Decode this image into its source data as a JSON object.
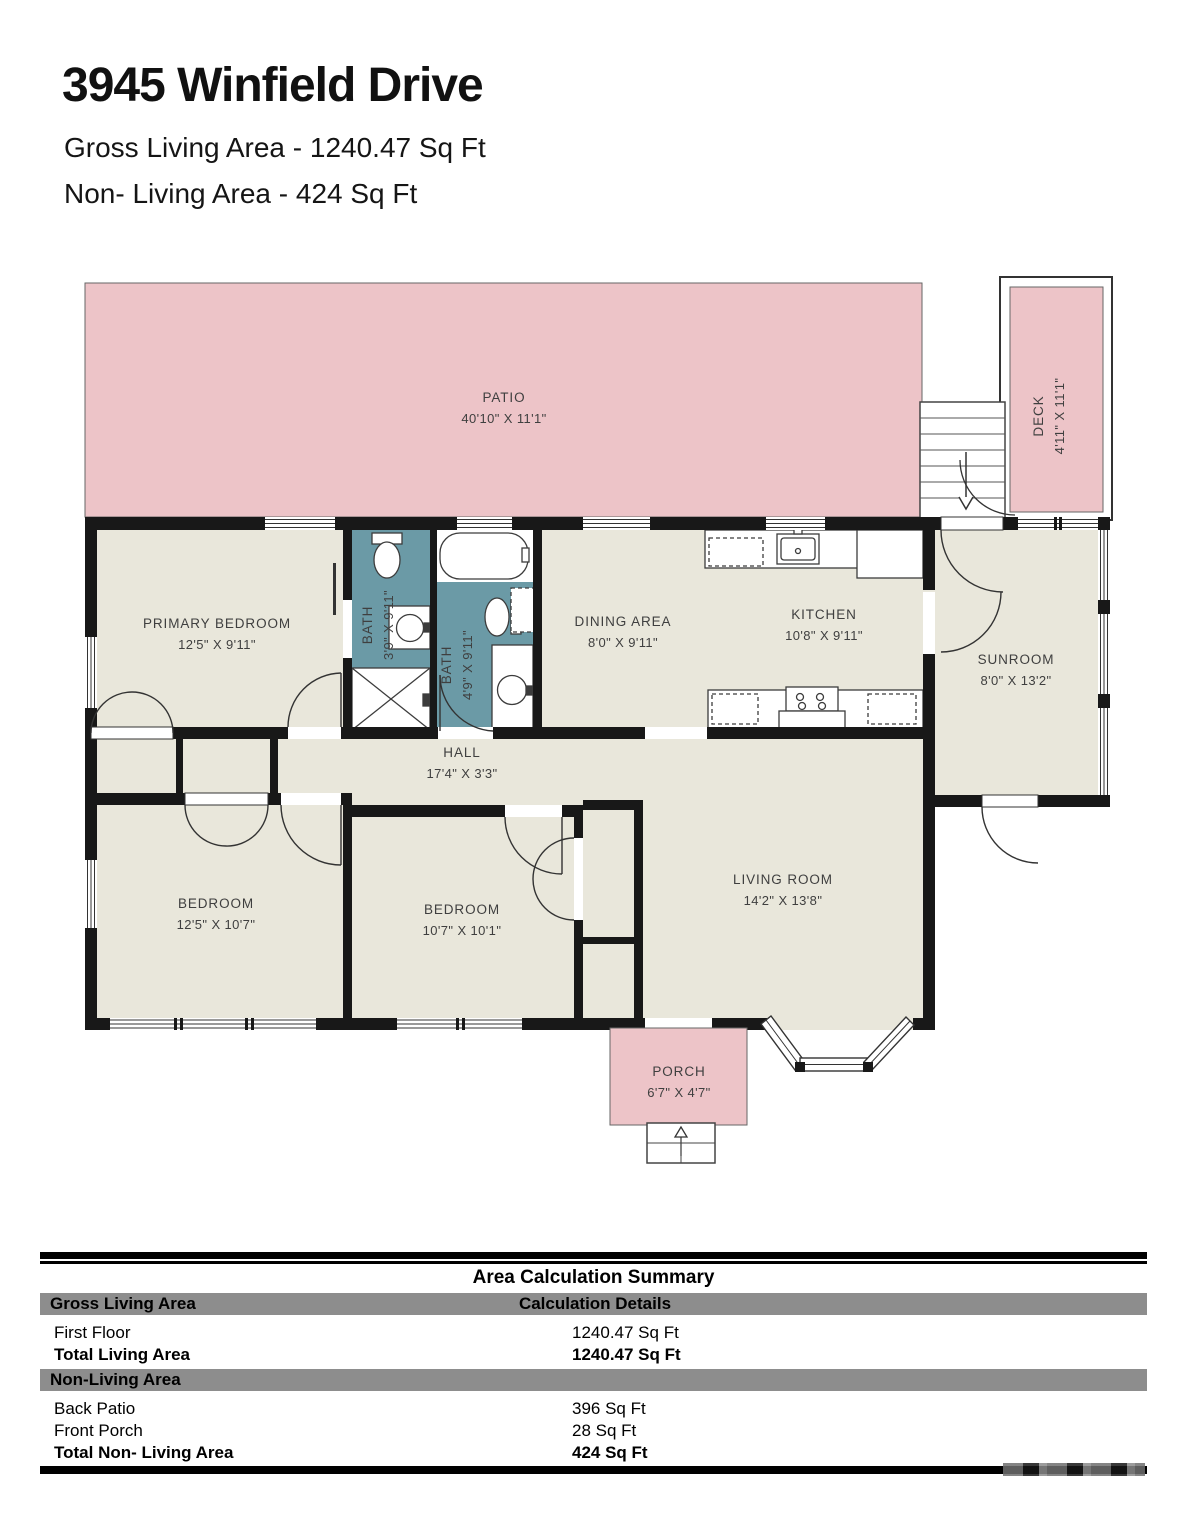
{
  "header": {
    "title": "3945 Winfield Drive",
    "subtitle1": "Gross Living Area - 1240.47 Sq Ft",
    "subtitle2": "Non- Living Area - 424 Sq Ft"
  },
  "colors": {
    "outdoor_pink": "#edc4c8",
    "bath_teal": "#6b9aa6",
    "floor_beige": "#e9e7db",
    "wall_black": "#181818",
    "table_header_gray": "#8d8d8d"
  },
  "rooms": {
    "patio": {
      "name": "PATIO",
      "dims": "40'10\" X 11'1\""
    },
    "deck": {
      "name": "DECK",
      "dims": "4'11\" X 11'1\""
    },
    "primary_bedroom": {
      "name": "PRIMARY BEDROOM",
      "dims": "12'5\" X 9'11\""
    },
    "bath1": {
      "name": "BATH",
      "dims": "3'9\" X 9'11\""
    },
    "bath2": {
      "name": "BATH",
      "dims": "4'9\" X 9'11\""
    },
    "dining": {
      "name": "DINING AREA",
      "dims": "8'0\" X 9'11\""
    },
    "kitchen": {
      "name": "KITCHEN",
      "dims": "10'8\" X 9'11\""
    },
    "sunroom": {
      "name": "SUNROOM",
      "dims": "8'0\" X 13'2\""
    },
    "hall": {
      "name": "HALL",
      "dims": "17'4\" X 3'3\""
    },
    "bedroom1": {
      "name": "BEDROOM",
      "dims": "12'5\" X 10'7\""
    },
    "bedroom2": {
      "name": "BEDROOM",
      "dims": "10'7\" X 10'1\""
    },
    "living_room": {
      "name": "LIVING ROOM",
      "dims": "14'2\" X 13'8\""
    },
    "porch": {
      "name": "PORCH",
      "dims": "6'7\" X 4'7\""
    }
  },
  "summary_table": {
    "title": "Area Calculation Summary",
    "col1_header": "Gross Living Area",
    "col2_header": "Calculation Details",
    "section2_header": "Non-Living Area",
    "rows": [
      {
        "label": "First Floor",
        "value": "1240.47 Sq Ft"
      },
      {
        "label": "Total Living Area",
        "value": "1240.47 Sq Ft"
      },
      {
        "label": "Back Patio",
        "value": "396 Sq Ft"
      },
      {
        "label": "Front Porch",
        "value": "28 Sq Ft"
      },
      {
        "label": "Total Non- Living Area",
        "value": "424 Sq Ft"
      }
    ]
  }
}
